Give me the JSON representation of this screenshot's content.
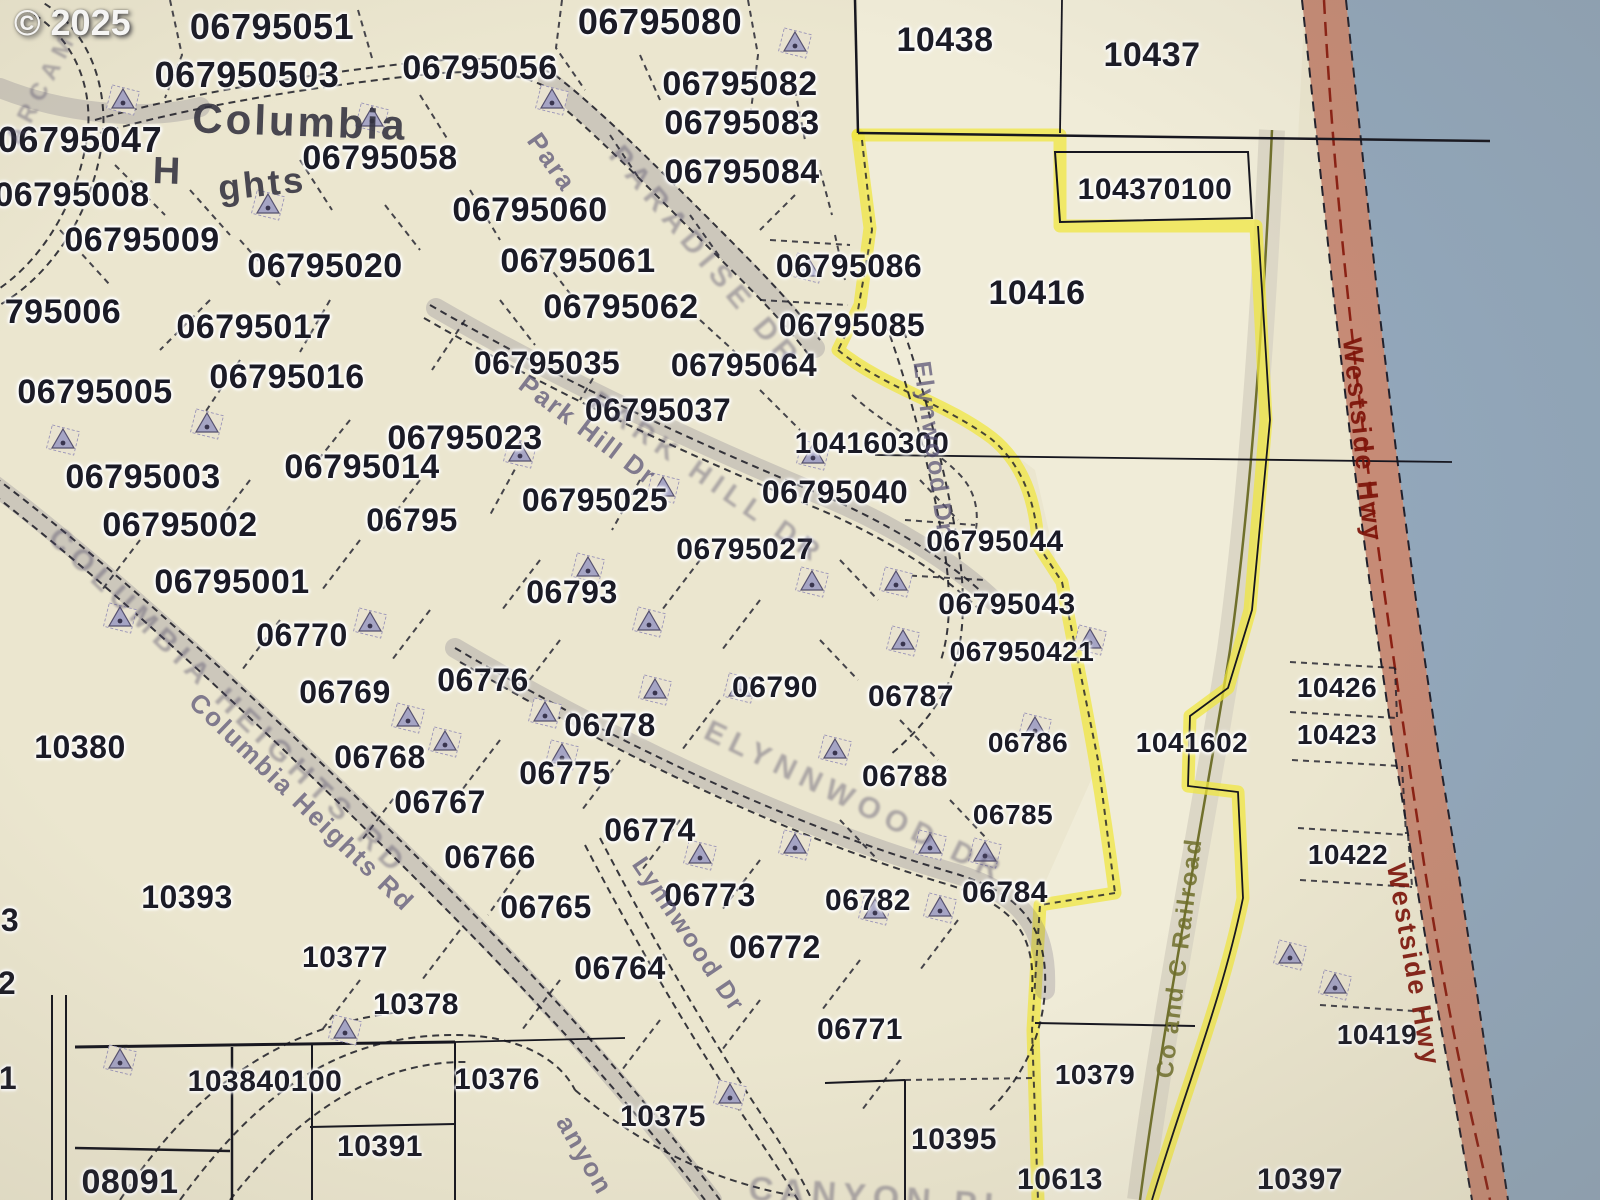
{
  "copyright": "© 2025",
  "colors": {
    "paper": "#ebe6cf",
    "paper_light": "#f1eedb",
    "water": "#92a7bb",
    "highway_fill": "#c2836f",
    "highway_centerline": "#8b2013",
    "highlight_yellow": "#f0e63c",
    "railroad_olive": "#70702c",
    "parcel_text": "#1b1b26"
  },
  "place_labels": [
    {
      "t": "Columbia",
      "x": 300,
      "y": 122,
      "s": 42,
      "r": 2
    },
    {
      "t": "H",
      "x": 168,
      "y": 172,
      "s": 38,
      "r": 2
    },
    {
      "t": "ghts",
      "x": 262,
      "y": 184,
      "s": 36,
      "r": -6
    }
  ],
  "road_labels": [
    {
      "t": "ARCAM",
      "x": 42,
      "y": 88,
      "s": 24,
      "r": -62,
      "c": "smudge"
    },
    {
      "t": "Para",
      "x": 552,
      "y": 162,
      "s": 26,
      "r": 55,
      "c": "road"
    },
    {
      "t": "PARADISE DR",
      "x": 705,
      "y": 258,
      "s": 30,
      "r": 50,
      "c": "smudge"
    },
    {
      "t": "Park Hill Dr",
      "x": 588,
      "y": 430,
      "s": 26,
      "r": 37,
      "c": "road"
    },
    {
      "t": "PARK HILL DR",
      "x": 708,
      "y": 478,
      "s": 28,
      "r": 35,
      "c": "smudge"
    },
    {
      "t": "Elynwood Dr",
      "x": 933,
      "y": 448,
      "s": 25,
      "r": 82,
      "c": "road"
    },
    {
      "t": "ELYNNWOOD DR",
      "x": 855,
      "y": 802,
      "s": 30,
      "r": 26,
      "c": "smudge"
    },
    {
      "t": "COLUMBIA HEIGHTS RD",
      "x": 228,
      "y": 702,
      "s": 30,
      "r": 44,
      "c": "smudge"
    },
    {
      "t": "Columbia Heights Rd",
      "x": 302,
      "y": 802,
      "s": 26,
      "r": 44,
      "c": "road"
    },
    {
      "t": "Lynnwood Dr",
      "x": 688,
      "y": 935,
      "s": 25,
      "r": 56,
      "c": "road"
    },
    {
      "t": "anyon",
      "x": 585,
      "y": 1155,
      "s": 26,
      "r": 60,
      "c": "road"
    },
    {
      "t": "CANYON PL",
      "x": 880,
      "y": 1198,
      "s": 34,
      "r": 4,
      "c": "smudge"
    },
    {
      "t": "Co and C Railroad",
      "x": 1180,
      "y": 958,
      "s": 24,
      "r": -83,
      "c": "rail"
    },
    {
      "t": "Westside Hwy",
      "x": 1362,
      "y": 440,
      "s": 27,
      "r": 84,
      "c": "hwy"
    },
    {
      "t": "Westside Hwy",
      "x": 1413,
      "y": 965,
      "s": 27,
      "r": 80,
      "c": "hwy"
    }
  ],
  "parcels": [
    {
      "t": "06795051",
      "x": 272,
      "y": 27,
      "s": 36
    },
    {
      "t": "067950503",
      "x": 247,
      "y": 75,
      "s": 36
    },
    {
      "t": "06795056",
      "x": 480,
      "y": 68,
      "s": 34
    },
    {
      "t": "06795080",
      "x": 660,
      "y": 22,
      "s": 36
    },
    {
      "t": "06795082",
      "x": 740,
      "y": 84,
      "s": 34
    },
    {
      "t": "06795083",
      "x": 742,
      "y": 123,
      "s": 34
    },
    {
      "t": "06795084",
      "x": 742,
      "y": 172,
      "s": 34
    },
    {
      "t": "10438",
      "x": 945,
      "y": 40,
      "s": 34
    },
    {
      "t": "10437",
      "x": 1152,
      "y": 55,
      "s": 34
    },
    {
      "t": "06795047",
      "x": 80,
      "y": 140,
      "s": 36
    },
    {
      "t": "06795058",
      "x": 380,
      "y": 158,
      "s": 34
    },
    {
      "t": "06795008",
      "x": 72,
      "y": 195,
      "s": 34
    },
    {
      "t": "06795060",
      "x": 530,
      "y": 210,
      "s": 34
    },
    {
      "t": "06795009",
      "x": 142,
      "y": 240,
      "s": 34
    },
    {
      "t": "06795020",
      "x": 325,
      "y": 266,
      "s": 34
    },
    {
      "t": "06795061",
      "x": 578,
      "y": 261,
      "s": 34
    },
    {
      "t": "06795086",
      "x": 849,
      "y": 266,
      "s": 32
    },
    {
      "t": "104370100",
      "x": 1155,
      "y": 190,
      "s": 30
    },
    {
      "t": "795006",
      "x": 63,
      "y": 312,
      "s": 34
    },
    {
      "t": "06795062",
      "x": 621,
      "y": 307,
      "s": 34
    },
    {
      "t": "06795085",
      "x": 852,
      "y": 325,
      "s": 32
    },
    {
      "t": "10416",
      "x": 1037,
      "y": 293,
      "s": 34
    },
    {
      "t": "06795017",
      "x": 254,
      "y": 327,
      "s": 34
    },
    {
      "t": "06795005",
      "x": 95,
      "y": 392,
      "s": 34
    },
    {
      "t": "06795016",
      "x": 287,
      "y": 377,
      "s": 34
    },
    {
      "t": "06795035",
      "x": 547,
      "y": 363,
      "s": 32
    },
    {
      "t": "06795064",
      "x": 744,
      "y": 365,
      "s": 32
    },
    {
      "t": "06795037",
      "x": 658,
      "y": 410,
      "s": 32
    },
    {
      "t": "06795023",
      "x": 465,
      "y": 438,
      "s": 34
    },
    {
      "t": "104160300",
      "x": 872,
      "y": 444,
      "s": 30
    },
    {
      "t": "06795003",
      "x": 143,
      "y": 477,
      "s": 34
    },
    {
      "t": "06795014",
      "x": 362,
      "y": 467,
      "s": 34
    },
    {
      "t": "06795025",
      "x": 595,
      "y": 500,
      "s": 32
    },
    {
      "t": "06795040",
      "x": 835,
      "y": 492,
      "s": 32
    },
    {
      "t": "06795002",
      "x": 180,
      "y": 525,
      "s": 34
    },
    {
      "t": "06795",
      "x": 412,
      "y": 520,
      "s": 32
    },
    {
      "t": "06795027",
      "x": 745,
      "y": 550,
      "s": 30
    },
    {
      "t": "06795044",
      "x": 995,
      "y": 542,
      "s": 30
    },
    {
      "t": "06795001",
      "x": 232,
      "y": 582,
      "s": 34
    },
    {
      "t": "06793",
      "x": 572,
      "y": 592,
      "s": 32
    },
    {
      "t": "06795043",
      "x": 1007,
      "y": 605,
      "s": 30
    },
    {
      "t": "06770",
      "x": 302,
      "y": 635,
      "s": 32
    },
    {
      "t": "067950421",
      "x": 1022,
      "y": 652,
      "s": 28
    },
    {
      "t": "06769",
      "x": 345,
      "y": 692,
      "s": 32
    },
    {
      "t": "06776",
      "x": 483,
      "y": 680,
      "s": 32
    },
    {
      "t": "06790",
      "x": 775,
      "y": 688,
      "s": 30
    },
    {
      "t": "06787",
      "x": 911,
      "y": 697,
      "s": 30
    },
    {
      "t": "10426",
      "x": 1337,
      "y": 688,
      "s": 28
    },
    {
      "t": "10380",
      "x": 80,
      "y": 747,
      "s": 32
    },
    {
      "t": "06768",
      "x": 380,
      "y": 757,
      "s": 32
    },
    {
      "t": "06778",
      "x": 610,
      "y": 725,
      "s": 32
    },
    {
      "t": "06786",
      "x": 1028,
      "y": 743,
      "s": 28
    },
    {
      "t": "1041602",
      "x": 1192,
      "y": 743,
      "s": 28
    },
    {
      "t": "10423",
      "x": 1337,
      "y": 735,
      "s": 28
    },
    {
      "t": "06775",
      "x": 565,
      "y": 773,
      "s": 32
    },
    {
      "t": "06788",
      "x": 905,
      "y": 777,
      "s": 30
    },
    {
      "t": "06767",
      "x": 440,
      "y": 802,
      "s": 32
    },
    {
      "t": "06785",
      "x": 1013,
      "y": 815,
      "s": 28
    },
    {
      "t": "06774",
      "x": 650,
      "y": 830,
      "s": 32
    },
    {
      "t": "06766",
      "x": 490,
      "y": 857,
      "s": 32
    },
    {
      "t": "10422",
      "x": 1348,
      "y": 855,
      "s": 28
    },
    {
      "t": "10393",
      "x": 187,
      "y": 897,
      "s": 32
    },
    {
      "t": "06765",
      "x": 546,
      "y": 907,
      "s": 32
    },
    {
      "t": "06773",
      "x": 710,
      "y": 895,
      "s": 32
    },
    {
      "t": "06782",
      "x": 868,
      "y": 901,
      "s": 30
    },
    {
      "t": "06784",
      "x": 1005,
      "y": 893,
      "s": 30
    },
    {
      "t": "06772",
      "x": 775,
      "y": 947,
      "s": 32
    },
    {
      "t": "10377",
      "x": 345,
      "y": 958,
      "s": 30
    },
    {
      "t": "06764",
      "x": 620,
      "y": 968,
      "s": 32
    },
    {
      "t": "10378",
      "x": 416,
      "y": 1005,
      "s": 30
    },
    {
      "t": "10419",
      "x": 1377,
      "y": 1035,
      "s": 28
    },
    {
      "t": "06771",
      "x": 860,
      "y": 1030,
      "s": 30
    },
    {
      "t": "103840100",
      "x": 265,
      "y": 1082,
      "s": 30
    },
    {
      "t": "10376",
      "x": 497,
      "y": 1080,
      "s": 30
    },
    {
      "t": "10375",
      "x": 663,
      "y": 1117,
      "s": 30
    },
    {
      "t": "10379",
      "x": 1095,
      "y": 1075,
      "s": 28
    },
    {
      "t": "10395",
      "x": 954,
      "y": 1140,
      "s": 30
    },
    {
      "t": "08091",
      "x": 130,
      "y": 1182,
      "s": 34
    },
    {
      "t": "10391",
      "x": 380,
      "y": 1147,
      "s": 30
    },
    {
      "t": "10613",
      "x": 1060,
      "y": 1180,
      "s": 30
    },
    {
      "t": "10397",
      "x": 1300,
      "y": 1180,
      "s": 30
    },
    {
      "t": "3",
      "x": 10,
      "y": 920,
      "s": 32
    },
    {
      "t": "2",
      "x": 7,
      "y": 983,
      "s": 32
    },
    {
      "t": "1",
      "x": 8,
      "y": 1078,
      "s": 32
    }
  ],
  "house_icons": [
    [
      123,
      100
    ],
    [
      372,
      118
    ],
    [
      552,
      100
    ],
    [
      795,
      43
    ],
    [
      808,
      268
    ],
    [
      268,
      205
    ],
    [
      207,
      424
    ],
    [
      63,
      440
    ],
    [
      520,
      453
    ],
    [
      663,
      488
    ],
    [
      813,
      455
    ],
    [
      588,
      568
    ],
    [
      649,
      622
    ],
    [
      812,
      582
    ],
    [
      896,
      582
    ],
    [
      903,
      641
    ],
    [
      120,
      618
    ],
    [
      370,
      623
    ],
    [
      408,
      718
    ],
    [
      545,
      713
    ],
    [
      445,
      742
    ],
    [
      655,
      690
    ],
    [
      740,
      688
    ],
    [
      835,
      750
    ],
    [
      1035,
      728
    ],
    [
      930,
      845
    ],
    [
      985,
      853
    ],
    [
      1090,
      640
    ],
    [
      120,
      1060
    ],
    [
      345,
      1030
    ],
    [
      730,
      1095
    ],
    [
      1290,
      955
    ],
    [
      1335,
      985
    ],
    [
      875,
      910
    ],
    [
      940,
      908
    ],
    [
      562,
      755
    ],
    [
      700,
      855
    ],
    [
      795,
      845
    ]
  ]
}
